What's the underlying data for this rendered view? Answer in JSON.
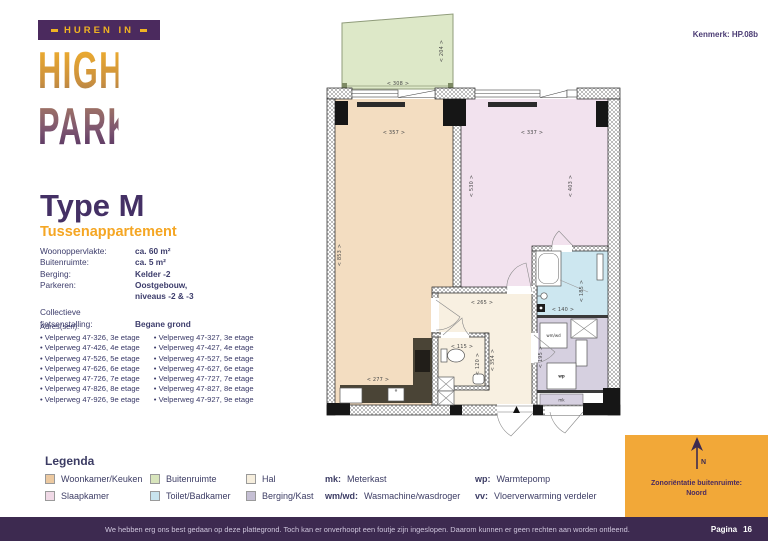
{
  "kenmerk": "Kenmerk: HP.08b",
  "logo": {
    "banner": "HUREN IN",
    "line1": "HIGH",
    "line2": "PARK"
  },
  "type": {
    "title": "Type M",
    "subtitle": "Tussenappartement"
  },
  "specs": {
    "rows": [
      {
        "label": "Woonoppervlakte:",
        "value": "ca. 60 m²"
      },
      {
        "label": "Buitenruimte:",
        "value": "ca. 5 m²"
      },
      {
        "label": "Berging:",
        "value": "Kelder -2"
      },
      {
        "label": "Parkeren:",
        "value": "Oostgebouw,"
      },
      {
        "label": "",
        "value": "niveaus -2 & -3"
      },
      {
        "label": "Collectieve",
        "value": ""
      },
      {
        "label": "fietsenstalling:",
        "value": "Begane grond"
      }
    ]
  },
  "addresses": {
    "header": "Adres(sen):",
    "left": [
      "Velperweg 47-326, 3e etage",
      "Velperweg 47-426, 4e etage",
      "Velperweg 47-526, 5e etage",
      "Velperweg 47-626, 6e etage",
      "Velperweg 47-726, 7e etage",
      "Velperweg 47-826, 8e etage",
      "Velperweg 47-926, 9e etage"
    ],
    "right": [
      "Velperweg 47-327, 3e etage",
      "Velperweg 47-427, 4e etage",
      "Velperweg 47-527, 5e etage",
      "Velperweg 47-627, 6e etage",
      "Velperweg 47-727, 7e etage",
      "Velperweg 47-827, 8e etage",
      "Velperweg 47-927, 9e etage"
    ]
  },
  "plan": {
    "dims": {
      "d308": "< 308 >",
      "d204": "< 204 >",
      "d357": "< 357 >",
      "d337": "< 337 >",
      "d853": "< 853 >",
      "d530": "< 530 >",
      "d403": "< 403 >",
      "d265": "< 265 >",
      "d354": "< 354 >",
      "d115": "< 115 >",
      "d120": "< 120 >",
      "d277": "< 277 >",
      "d140": "< 140 >",
      "d185": "< 185 >",
      "d195": "< 195 >"
    },
    "labels": {
      "wmwd": "wm/wd",
      "wp": "wp",
      "mk": "mk"
    }
  },
  "legend": {
    "title": "Legenda",
    "items": [
      {
        "label": "Woonkamer/Keuken",
        "color": "#ecc9a0"
      },
      {
        "label": "Slaapkamer",
        "color": "#f0d9e6"
      },
      {
        "label": "Buitenruimte",
        "color": "#d8e5bc"
      },
      {
        "label": "Toilet/Badkamer",
        "color": "#c8e4ee"
      },
      {
        "label": "Hal",
        "color": "#f6eedd"
      },
      {
        "label": "Berging/Kast",
        "color": "#c5bfd4"
      }
    ],
    "abbr": [
      {
        "key": "mk:",
        "text": "Meterkast"
      },
      {
        "key": "wm/wd:",
        "text": "Wasmachine/wasdroger"
      },
      {
        "key": "wp:",
        "text": "Warmtepomp"
      },
      {
        "key": "vv:",
        "text": "Vloerverwarming verdeler"
      }
    ]
  },
  "compass": {
    "label": "Zonoriëntatie buitenruimte:",
    "value": "Noord",
    "letter": "N"
  },
  "footer": {
    "disclaimer": "We hebben erg ons best gedaan op deze plattegrond. Toch kan er onverhoopt een foutje zijn ingeslopen. Daarom kunnen er geen rechten aan worden ontleend.",
    "page_label": "Pagina",
    "page_number": "16"
  },
  "colors": {
    "accent_orange": "#f2a838",
    "purple_dark": "#3d2a50",
    "navy_text": "#3c3c64",
    "room_woonkamer": "#f3ddc1",
    "room_slaapkamer": "#f2e2ee",
    "room_buitenruimte": "#dde8c8",
    "room_toilet_badkamer": "#cde7f0",
    "room_hal": "#f8f0e1",
    "room_berging": "#d6d0e0",
    "kitchen_counter": "#4a4436"
  }
}
